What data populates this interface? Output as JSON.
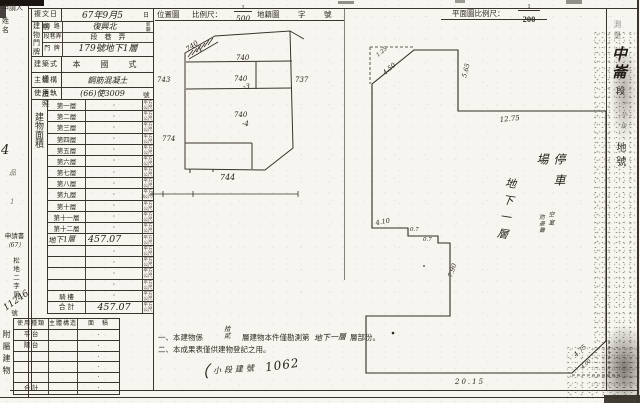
{
  "applicant_box": {
    "line1": "申請人",
    "line2": "姓 名"
  },
  "margin": {
    "mark_top": "4",
    "mark_a": "品",
    "mark_b": "1",
    "doc": "申請書",
    "doc_year": "（67）",
    "doc_prefix": "松地二字第",
    "doc_number": "11246",
    "doc_suffix": "號"
  },
  "form": {
    "date": {
      "label": "複文日期",
      "value": "67年9月5",
      "suffix": "日"
    },
    "address_label": "建物門牌",
    "address_rows": [
      {
        "label": "街 路",
        "value": "復興北",
        "note1": "新",
        "note2": "闢"
      },
      {
        "label": "段巷弄",
        "value": "段　巷　弄",
        "note1": "",
        "note2": ""
      },
      {
        "label": "門 牌",
        "value": "179號地下1層",
        "note1": "",
        "note2": ""
      }
    ],
    "style_row": {
      "label": "建築式樣",
      "value": "本　國　式"
    },
    "structure_row": {
      "label": "主體構造",
      "value": "鋼筋混凝土"
    },
    "license_row": {
      "label": "使用執照",
      "value": "(66)使3009",
      "suffix": "號"
    }
  },
  "area_table": {
    "side_label": "建物面積",
    "unit_top": "平方",
    "unit_bottom": "公尺",
    "rows": [
      {
        "label": "第一層",
        "value": "·"
      },
      {
        "label": "第二層",
        "value": "·"
      },
      {
        "label": "第三層",
        "value": "·"
      },
      {
        "label": "第四層",
        "value": "·"
      },
      {
        "label": "第五層",
        "value": "·"
      },
      {
        "label": "第六層",
        "value": "·"
      },
      {
        "label": "第七層",
        "value": "·"
      },
      {
        "label": "第八層",
        "value": "·"
      },
      {
        "label": "第九層",
        "value": "·"
      },
      {
        "label": "第十層",
        "value": "·"
      },
      {
        "label": "第十一層",
        "value": "·"
      },
      {
        "label": "第十二層",
        "value": "·"
      },
      {
        "label": "地下1層",
        "value": "457.07"
      },
      {
        "label": "",
        "value": "·"
      },
      {
        "label": "",
        "value": "·"
      },
      {
        "label": "",
        "value": "·"
      },
      {
        "label": "",
        "value": "·"
      },
      {
        "label": "騎 樓",
        "value": "·"
      },
      {
        "label": "合 計",
        "value": "457.07"
      }
    ]
  },
  "annex_table": {
    "side_label": "附屬建物",
    "col1": "使用種類",
    "col2": "主體構造",
    "col3": "面　積",
    "rows": [
      {
        "label": "平 台",
        "value": "·"
      },
      {
        "label": "陽 台",
        "value": "·"
      },
      {
        "label": "",
        "value": "·"
      },
      {
        "label": "",
        "value": "·"
      },
      {
        "label": "",
        "value": "·"
      },
      {
        "label": "合 計",
        "value": "·"
      }
    ]
  },
  "location_map": {
    "title": "位置圖",
    "scale_label": "比例尺：",
    "scale_top": "1",
    "scale_bottom": "500",
    "suffix1": "地籍圖",
    "suffix2": "字",
    "suffix3": "號",
    "scale_bar_mark": "3·",
    "parcels": {
      "p1a": "740",
      "p1b": "-1",
      "p2": "740",
      "p3": "743",
      "p4a": "740",
      "p4b": "-3",
      "p5": "737",
      "p6a": "740",
      "p6b": "-4",
      "p7": "774",
      "p8": "744"
    }
  },
  "floor_plan": {
    "title": "平面圖比例尺：",
    "scale_top": "1",
    "scale_bottom": "200",
    "room_labels": {
      "parking": "停車場",
      "floor": "地下一層",
      "small_right": "空室",
      "small_left": "防避難"
    },
    "dims": {
      "chamfer_small": "1.25",
      "chamfer": "4.50",
      "right_top": "5.65",
      "top": "12.75",
      "notch_top": "4.10",
      "step1": "0.7",
      "step2": "0.7",
      "notch_right": "7.90",
      "bottom": "20.15",
      "corner": "4.75",
      "corner_small": "4.00"
    }
  },
  "side_title": {
    "faint": "測量",
    "big": "中崙",
    "mid": "段",
    "small": "一小段",
    "end": "地號"
  },
  "notes": {
    "line1_pre": "一、本建物係",
    "line1_fill_top": "拾",
    "line1_fill_bottom": "貳",
    "line1_mid": "層建物本件僅勘測第",
    "line1_hw": "地下一層",
    "line1_post": "層部份。",
    "line2": "二、本成果表僅供建物登記之用。",
    "hw_paren": "（",
    "hw_text": "小段建號",
    "hw_number": "1062"
  }
}
